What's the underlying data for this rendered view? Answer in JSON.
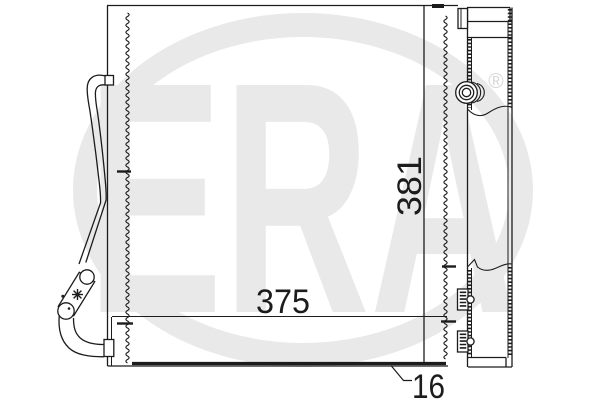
{
  "diagram": {
    "labels": {
      "width": "375",
      "height": "381",
      "depth": "16"
    },
    "watermark": {
      "brand": "ERA",
      "registered": "®"
    },
    "colors": {
      "line": "#1c1c1c",
      "background": "#ffffff",
      "watermark": "#e9e9e9",
      "watermark_mark": "#d7d7d7"
    }
  }
}
